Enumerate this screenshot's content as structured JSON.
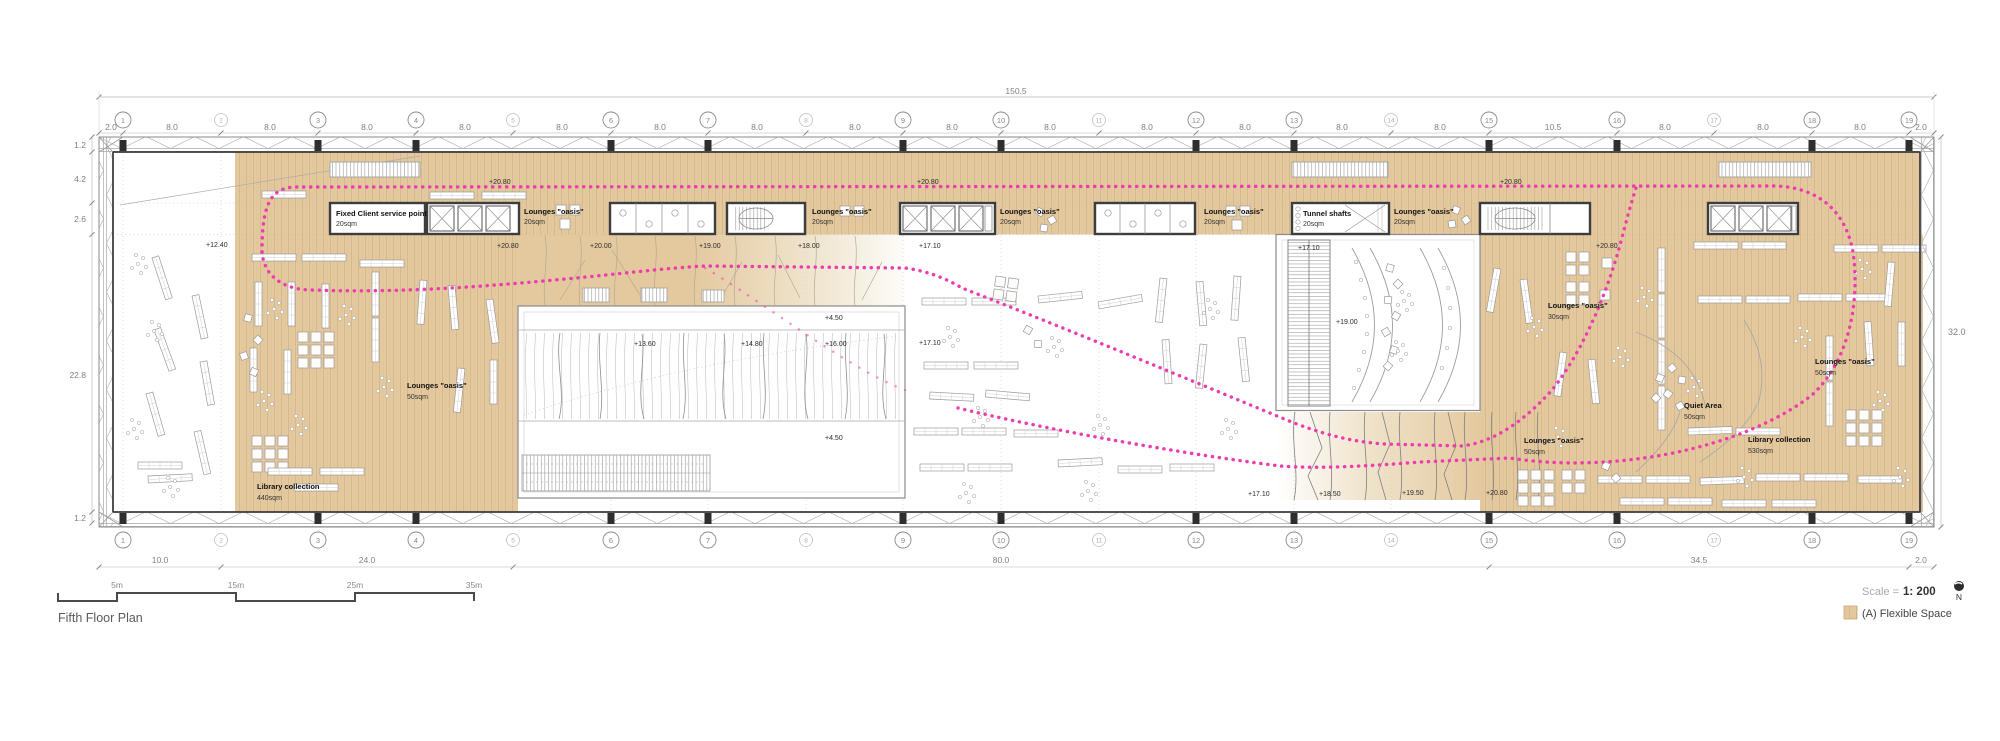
{
  "title": "Fifth Floor Plan",
  "footer": {
    "scale_label": "Scale =",
    "scale_value": "1: 200",
    "north_label": "N",
    "legend_flexible": "(A) Flexible Space"
  },
  "scalebar": {
    "marks": [
      "5m",
      "15m",
      "25m",
      "35m"
    ]
  },
  "grid": {
    "labels": [
      "1",
      "2",
      "3",
      "4",
      "5",
      "6",
      "7",
      "8",
      "9",
      "10",
      "11",
      "12",
      "13",
      "14",
      "15",
      "16",
      "17",
      "18",
      "19"
    ]
  },
  "dims": {
    "total_width": "150.5",
    "right_height": "32.0",
    "left": [
      "1.2",
      "4.2",
      "2.6",
      "22.8",
      "1.2"
    ],
    "top_segments": [
      "2.0",
      "8.0",
      "8.0",
      "8.0",
      "8.0",
      "8.0",
      "8.0",
      "8.0",
      "8.0",
      "8.0",
      "8.0",
      "8.0",
      "8.0",
      "8.0",
      "8.0",
      "10.5",
      "8.0",
      "8.0",
      "8.0",
      "2.0"
    ],
    "bottom_segments": [
      "10.0",
      "24.0",
      "80.0",
      "34.5",
      "2.0"
    ]
  },
  "rooms": [
    {
      "name": "Fixed Client service point",
      "area": "20sqm"
    },
    {
      "name": "Lounges \"oasis\"",
      "area": "20sqm"
    },
    {
      "name": "Lounges \"oasis\"",
      "area": "20sqm"
    },
    {
      "name": "Lounges \"oasis\"",
      "area": "20sqm"
    },
    {
      "name": "Lounges \"oasis\"",
      "area": "20sqm"
    },
    {
      "name": "Tunnel shafts",
      "area": "20sqm"
    },
    {
      "name": "Lounges \"oasis\"",
      "area": "20sqm"
    },
    {
      "name": "Lounges \"oasis\"",
      "area": "50sqm"
    },
    {
      "name": "Library collection",
      "area": "440sqm"
    },
    {
      "name": "Lounges \"oasis\"",
      "area": "30sqm"
    },
    {
      "name": "Lounges \"oasis\"",
      "area": "50sqm"
    },
    {
      "name": "Quiet Area",
      "area": "50sqm"
    },
    {
      "name": "Library collection",
      "area": "530sqm"
    },
    {
      "name": "Lounges \"oasis\"",
      "area": "50sqm"
    }
  ],
  "levels": [
    "+12.40",
    "+20.80",
    "+20.80",
    "+20.80",
    "+20.80",
    "+20.00",
    "+19.00",
    "+18.00",
    "+17.10",
    "+17.10",
    "+20.80",
    "+19.00",
    "+4.50",
    "+13.60",
    "+14.80",
    "+16.00",
    "+17.10",
    "+4.50",
    "+17.10",
    "+18.50",
    "+19.50",
    "+20.80"
  ],
  "colors": {
    "flexible_space": "#e4c99f",
    "route": "#ec3cae",
    "core_wall": "#3d3d3d"
  }
}
